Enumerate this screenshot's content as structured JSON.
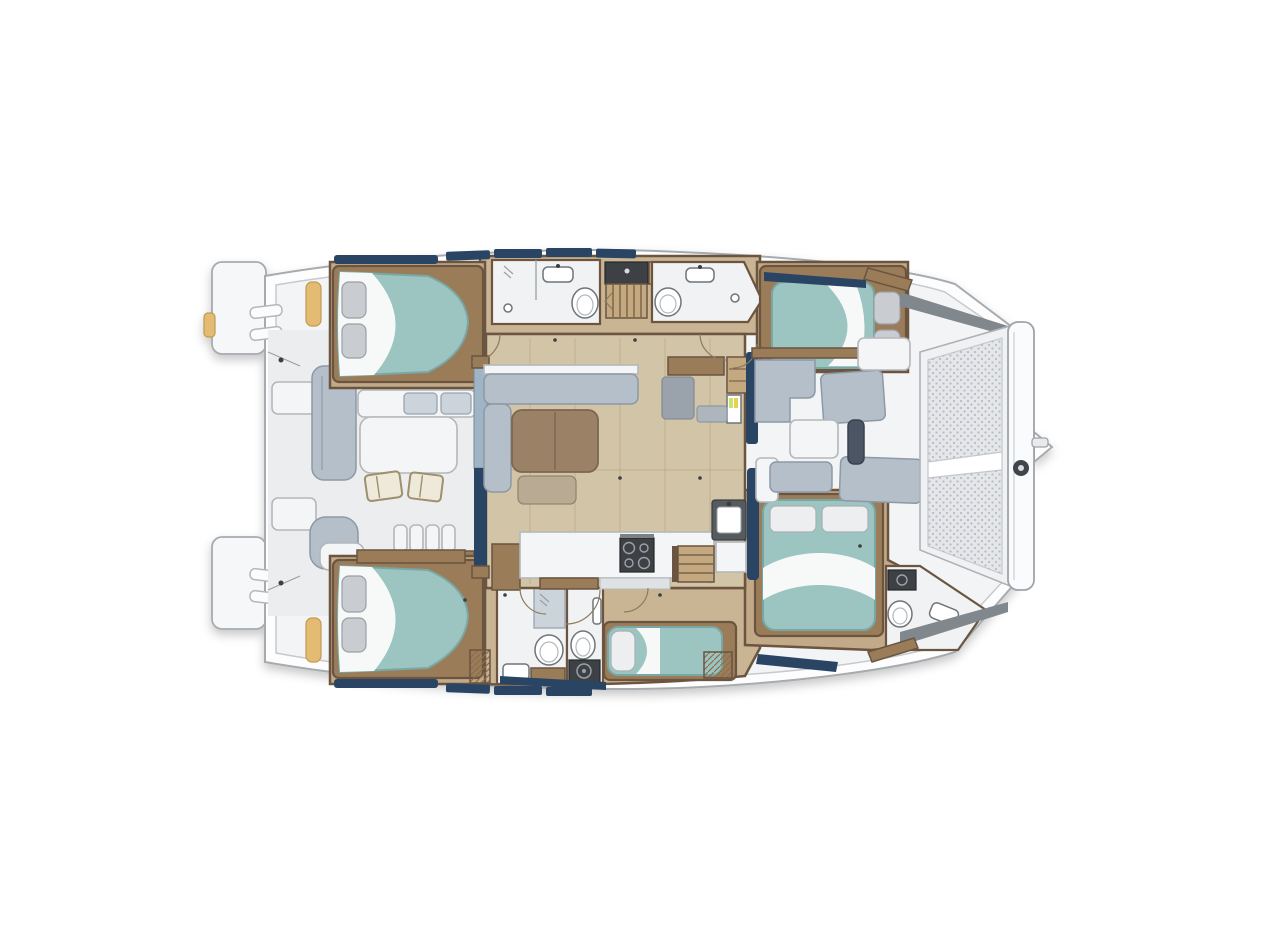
{
  "page": {
    "title": "Catamaran yacht interior layout floor plan, overhead view, bow to the right",
    "background": "#ffffff"
  },
  "colors": {
    "hull_outline": "#a6abb0",
    "deck": "#f3f4f6",
    "deck_line": "#c6cacd",
    "cockpit": "#ebedee",
    "wood_floor": "#c9b493",
    "cabin_floor": "#c2a987",
    "saloon_floor": "#d2c4a6",
    "wood_dark": "#6b5540",
    "wood_mid": "#9a7c59",
    "wood_light": "#c4a87f",
    "bathroom": "#f1f2f3",
    "teal": "#9cc4c1",
    "teal_deep": "#79a7a5",
    "sheet": "#f7f9f9",
    "pillow": "#c9cdd1",
    "sofa": "#b4bfca",
    "sofa_light": "#ccd4db",
    "cushion_tan": "#e3bb72",
    "table_brown": "#9b8165",
    "navy": "#2a4564",
    "slate": "#4b5563",
    "dark_appliance": "#3d4145",
    "mesh": "#e4e6e9",
    "mesh_dot": "#b7bcc2",
    "shadow_wedge": "#80878d"
  },
  "vessel": {
    "type": "catamaran",
    "view": "overhead floor plan",
    "bow_side": "right",
    "stern_side": "left",
    "cabins_double": 4,
    "berth_single": 1,
    "heads": 4,
    "features": [
      "twin swim platforms with transom steps",
      "aft cockpit with table and two chairs",
      "L-shaped cockpit settee and helm lounge",
      "saloon with settee and wood table",
      "nav station and fridge",
      "galley with stove and sink",
      "port aft double cabin",
      "port aft head with shower",
      "port forward head with shower",
      "port forward double cabin",
      "starboard aft double cabin",
      "starboard aft head with washer",
      "single berth amidships starboard",
      "starboard forward double cabin",
      "starboard forward head with vanity",
      "forward cockpit lounge cushions",
      "bow trampoline with crossbeam and bowsprit"
    ]
  }
}
